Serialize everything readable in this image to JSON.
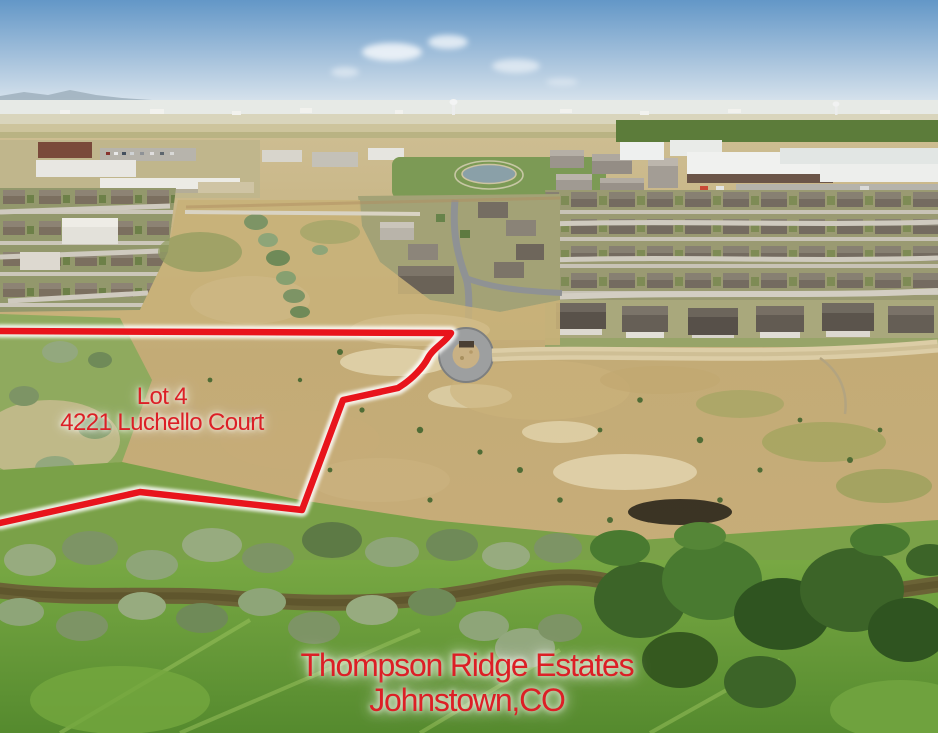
{
  "scene": {
    "kind": "aerial-drone-photo",
    "width": 938,
    "height": 733,
    "description": "Aerial view of a vacant hillside lot outlined in red, with suburban neighborhoods, warehouses and a river greenbelt"
  },
  "overlay": {
    "lot_label": {
      "line1": "Lot 4",
      "line2": "4221 Luchello Court"
    },
    "location_label": {
      "line1": "Thompson Ridge Estates",
      "line2": "Johnstown,CO"
    },
    "text_color": "#dc1f26",
    "boundary_color": "#e8141c",
    "boundary_glow": "#ffffff",
    "boundary_path": "M 0,331 L 451,333 C 446,342 433,348 428,358 C 424,366 413,379 398,388 L 343,400 L 302,510 L 140,492 L 0,523"
  },
  "palette": {
    "sky_top": "#6397c7",
    "sky_horizon": "#e2eaf0",
    "dry_grass": "#c3ab76",
    "sand": "#e0d2ab",
    "meadow_green": "#73a43f",
    "tree_dark_green": "#3c6428",
    "tree_sage": "#97ab7f",
    "river": "#6b6336",
    "asphalt": "#9d9fa0",
    "dirt_road": "#dccda6"
  }
}
